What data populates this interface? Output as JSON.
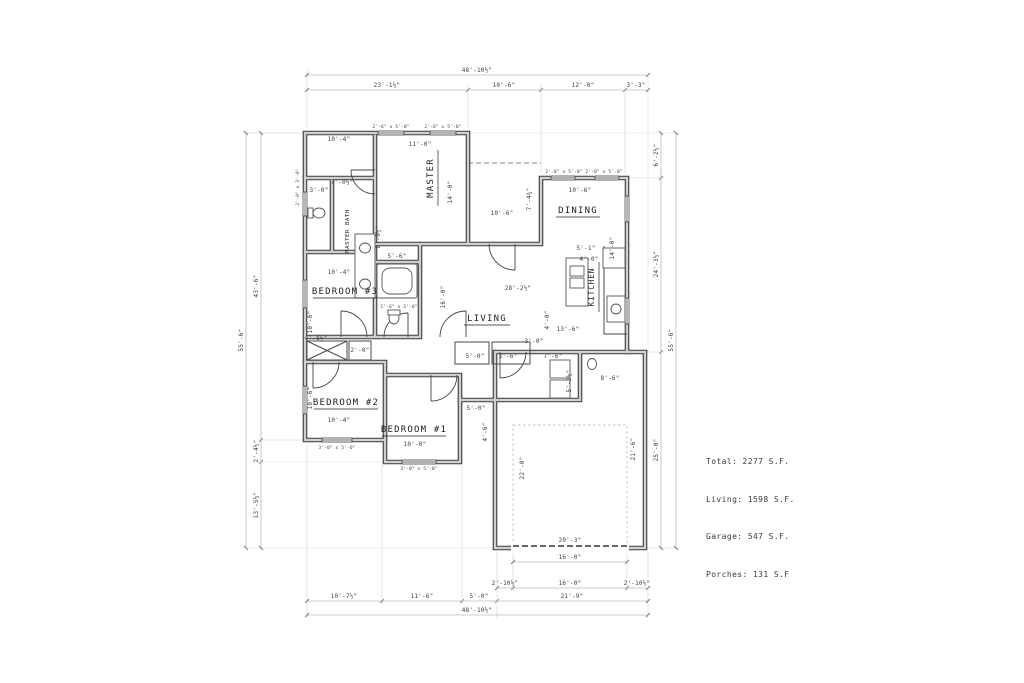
{
  "summary": {
    "total": "Total: 2277 S.F.",
    "living": "Living: 1598 S.F.",
    "garage": "Garage: 547 S.F.",
    "porches": "Porches: 131 S.F"
  },
  "rooms": {
    "master": "MASTER",
    "master_bath": "MASTER BATH",
    "dining": "DINING",
    "kitchen": "KITCHEN",
    "living": "LIVING",
    "bedroom3": "BEDROOM #3",
    "bedroom2": "BEDROOM #2",
    "bedroom1": "BEDROOM #1"
  },
  "labels": {
    "top_overall": "48'-10½\"",
    "top_seg1": "23'-1½\"",
    "top_seg2": "10'-6\"",
    "top_seg3": "12'-0\"",
    "top_seg4": "3'-3\"",
    "bottom_overall": "48'-10½\"",
    "bottom_seg1": "10'-7½\"",
    "bottom_seg2": "11'-6\"",
    "bottom_seg3": "5'-0\"",
    "bottom_seg4": "21'-9\"",
    "garage_seg1": "2'-10½\"",
    "garage_seg2": "16'-0\"",
    "garage_seg3": "2'-10½\"",
    "garage_door": "16'-0\"",
    "left_overall": "55'-6\"",
    "left_seg1": "43'-6\"",
    "left_seg2": "2'-4½\"",
    "left_seg3": "13'-5½\"",
    "right_overall": "55'-6\"",
    "right_seg1": "6'-2½\"",
    "right_seg2": "24'-3½\"",
    "right_seg3": "25'-0\"",
    "master_w": "11'-0\"",
    "master_h": "14'-0\"",
    "mcloset": "10'-4\"",
    "bath_w": "7'-0½\"",
    "bath_h": "8'-9½\"",
    "wc": "3'-0\"",
    "bed3_w": "10'-4\"",
    "bed3_h": "10'-6\"",
    "bath2_w": "5'-6\"",
    "closet1": "4'-8½\"",
    "closet2": "2'-0\"",
    "bed2_h": "10'-6\"",
    "bed2_w": "10'-4\"",
    "bed1_w": "10'-0\"",
    "hall1": "5'-0\"",
    "hall2": "3'-6\"",
    "hall3": "7'-6\"",
    "patio1": "5'-0\"",
    "patio2": "4'-6\"",
    "living_w": "28'-2½\"",
    "living_h": "16'-0\"",
    "kit1": "5'-1\"",
    "kit2": "4'-0\"",
    "kit3": "4'-0\"",
    "kit4": "13'-6\"",
    "dining_w": "10'-6\"",
    "dining_h": "14'-0\"",
    "porch_h": "7'-4¾\"",
    "porch_w": "10'-6\"",
    "util1": "3'-0\"",
    "util2": "5'-2½\"",
    "util3": "8'-6\"",
    "gar1": "22'-0\"",
    "gar2": "21'-6\"",
    "gar3": "20'-3\"",
    "win_2650a": "2'-6\" x 5'-0\"",
    "win_2650b": "2'-6\" x 5'-0\"",
    "win_dining": "2'-0\" x 5'-0\"  2'-0\" x 5'-0\"",
    "win_wc": "2'-0\" x 3'-0\"",
    "win_bed2": "3'-0\" x 5'-0\"",
    "win_bed1": "3'-0\" x 5'-0\"",
    "win_bath2": "1'-6\" x 3'-0\""
  }
}
